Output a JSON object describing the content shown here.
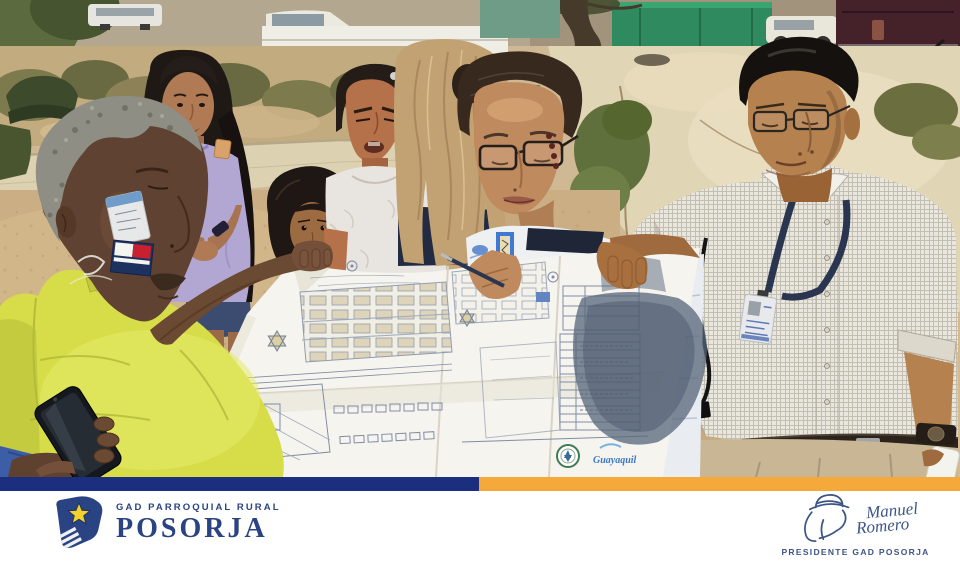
{
  "photo": {
    "map": {
      "logo_text": "Guayaquil"
    }
  },
  "footer": {
    "brand_small": "GAD PARROQUIAL RURAL",
    "brand_large": "POSORJA",
    "signature": {
      "first": "Manuel",
      "last": "Romero",
      "title": "PRESIDENTE GAD POSORJA"
    },
    "colors": {
      "bar_navy": "#1c2e7e",
      "bar_orange": "#f5a93b",
      "logo_navy": "#2a4382",
      "star_yellow": "#f4d22b",
      "signature_navy": "#3d5587"
    }
  }
}
